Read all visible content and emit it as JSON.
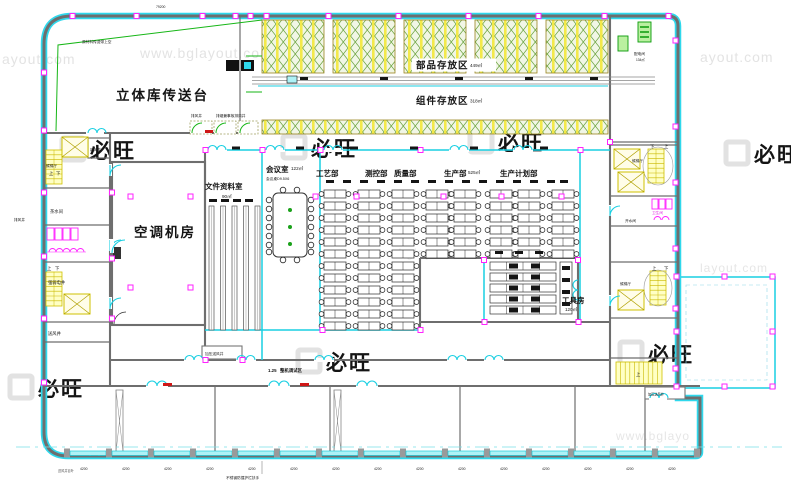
{
  "watermark": {
    "logo_text": "必旺",
    "url_full": "www.bglayout.com",
    "url_a": "ayout.com",
    "url_b": "www.bglayout.c",
    "url_c": "layout.com",
    "url_d": "www.bglayo"
  },
  "rooms": {
    "conveyor_platform": {
      "label": "立体库传送台"
    },
    "parts_storage": {
      "label": "部品存放区",
      "area": "449㎡"
    },
    "component_storage": {
      "label": "组件存放区",
      "area": "318㎡"
    },
    "document_room": {
      "label": "文件资料室",
      "area": "90㎡"
    },
    "meeting_room": {
      "label": "会议室",
      "area": "122㎡",
      "note": "会议桌D9.5X6"
    },
    "hvac_room": {
      "label": "空调机房"
    },
    "tool_room": {
      "label": "工具房",
      "area": "120㎡"
    },
    "power_room": {
      "label": "配电间",
      "area": "134㎡"
    },
    "tea_room": {
      "label": "茶水间"
    },
    "water_room": {
      "label": "开水间"
    },
    "toilet": {
      "label": "卫生间"
    },
    "elevator_lobby": {
      "label": "候梯厅"
    },
    "debug_area": {
      "label": "整机调试区",
      "value": "1.25"
    }
  },
  "departments": {
    "process": "工艺部",
    "measurement": "测控部",
    "quality": "质量部",
    "production": "生产部",
    "production_area": "525㎡",
    "planning": "生产计划部"
  },
  "shafts": {
    "exhaust": "排风井",
    "smoke_exhaust": "排烟兼事故排风井",
    "fresh_air": "新风井",
    "supply_air": "送风井",
    "pressurized_supply": "加压送风井",
    "electrical": "强弱电井",
    "louver_note": "送风井百叶"
  },
  "stairs": {
    "up": "上",
    "down": "下"
  },
  "annotations": {
    "overhead_conveyor": "原材料传送带上空",
    "handrail_note": "不锈钢防撞护栏扶手"
  },
  "dimensions": {
    "bay": "4200",
    "total_width": "79200"
  }
}
